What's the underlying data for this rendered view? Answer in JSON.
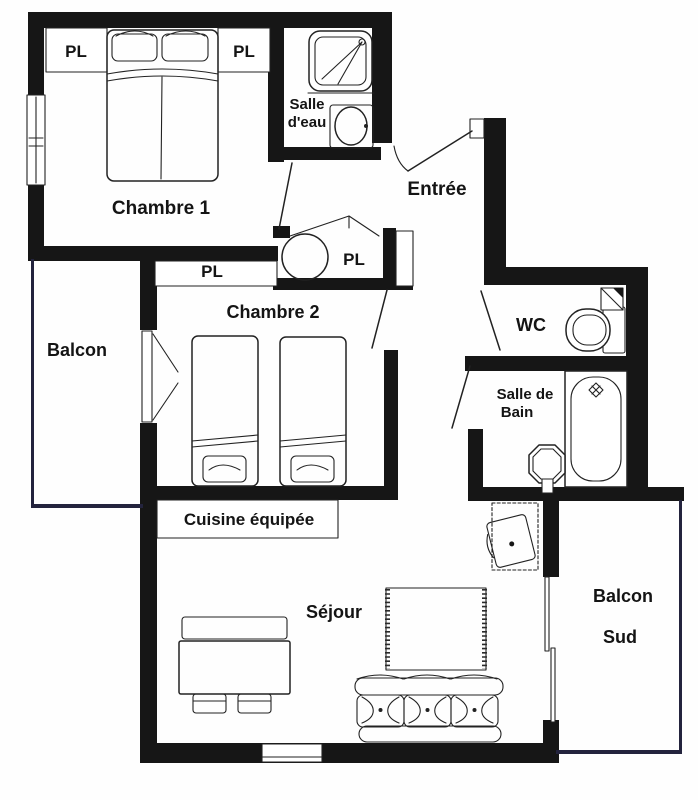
{
  "plan": {
    "type": "apartment-floor-plan",
    "colors": {
      "wall": "#161616",
      "line": "#222222",
      "railing": "#23233d",
      "background": "#fefefe",
      "label": "#141414"
    },
    "rooms": {
      "chambre1": {
        "label": "Chambre 1"
      },
      "chambre2": {
        "label": "Chambre 2"
      },
      "balcon": {
        "label": "Balcon"
      },
      "balcon_sud": {
        "line1": "Balcon",
        "line2": "Sud"
      },
      "entree": {
        "label": "Entrée"
      },
      "salle_eau": {
        "line1": "Salle",
        "line2": "d'eau"
      },
      "wc": {
        "label": "WC"
      },
      "salle_de_bain": {
        "line1": "Salle de",
        "line2": "Bain"
      },
      "cuisine": {
        "label": "Cuisine équipée"
      },
      "sejour": {
        "label": "Séjour"
      }
    },
    "closets": {
      "pl_chambre1_left": "PL",
      "pl_chambre1_right": "PL",
      "pl_chambre2": "PL",
      "pl_entree": "PL"
    },
    "fixtures": {
      "chambre1": [
        "double-bed"
      ],
      "chambre2": [
        "single-bed",
        "single-bed"
      ],
      "salle_eau": [
        "shower",
        "washbasin"
      ],
      "entree_closet": [
        "water-heater"
      ],
      "wc": [
        "toilet",
        "corner-washbasin"
      ],
      "salle_de_bain": [
        "bathtub",
        "pedestal-washbasin"
      ],
      "sejour": [
        "bench",
        "dining-table",
        "chair",
        "chair",
        "rug",
        "sofa",
        "desk",
        "desk-chair"
      ],
      "doors": [
        "entry-door",
        "chambre1-door",
        "chambre2-door",
        "wc-door",
        "salle-de-bain-door",
        "french-door-balcon",
        "pl-double-doors",
        "sliding-door-balcon-sud"
      ],
      "windows": [
        "chambre1-window",
        "sejour-window"
      ]
    }
  }
}
